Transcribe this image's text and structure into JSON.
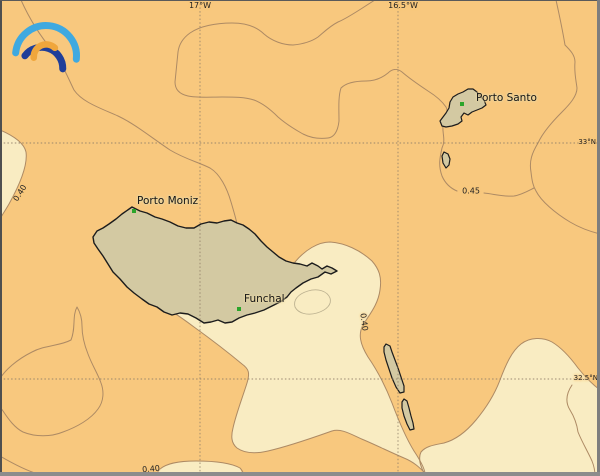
{
  "map": {
    "logo": {
      "name": "rainbow-arcs-logo"
    },
    "grid": {
      "meridians": [
        {
          "label": "17°W",
          "x": 200
        },
        {
          "label": "16.5°W",
          "x": 403
        }
      ],
      "parallels": [
        {
          "label": "33°N",
          "y": 143
        },
        {
          "label": "32.5°N",
          "y": 379
        }
      ]
    },
    "places": [
      {
        "name": "Porto Moniz",
        "x": 134,
        "y": 211
      },
      {
        "name": "Funchal",
        "x": 239,
        "y": 309
      },
      {
        "name": "Porto Santo",
        "x": 462,
        "y": 104
      }
    ],
    "contour_labels": [
      {
        "value": "0.40",
        "x": 20,
        "y": 193,
        "rotation": -58
      },
      {
        "value": "0.45",
        "x": 471,
        "y": 191,
        "rotation": 0
      },
      {
        "value": "0.40",
        "x": 364,
        "y": 322,
        "rotation": 83
      },
      {
        "value": "0.40",
        "x": 151,
        "y": 469,
        "rotation": -5
      }
    ],
    "colors": {
      "sea_base": "#f8c87e",
      "sea_light": "#f9ecc2",
      "land": "#d3c9a2",
      "coastline": "#1c1c1c",
      "contour": "#ad8a64",
      "contour_faint": "#bdb291",
      "grid": "#8f7e68",
      "town_marker": "#2aa52a",
      "label_text": "#1f1f1f",
      "logo_light_blue": "#3fa9e0",
      "logo_navy": "#203e99",
      "logo_orange": "#f0a63c"
    }
  }
}
